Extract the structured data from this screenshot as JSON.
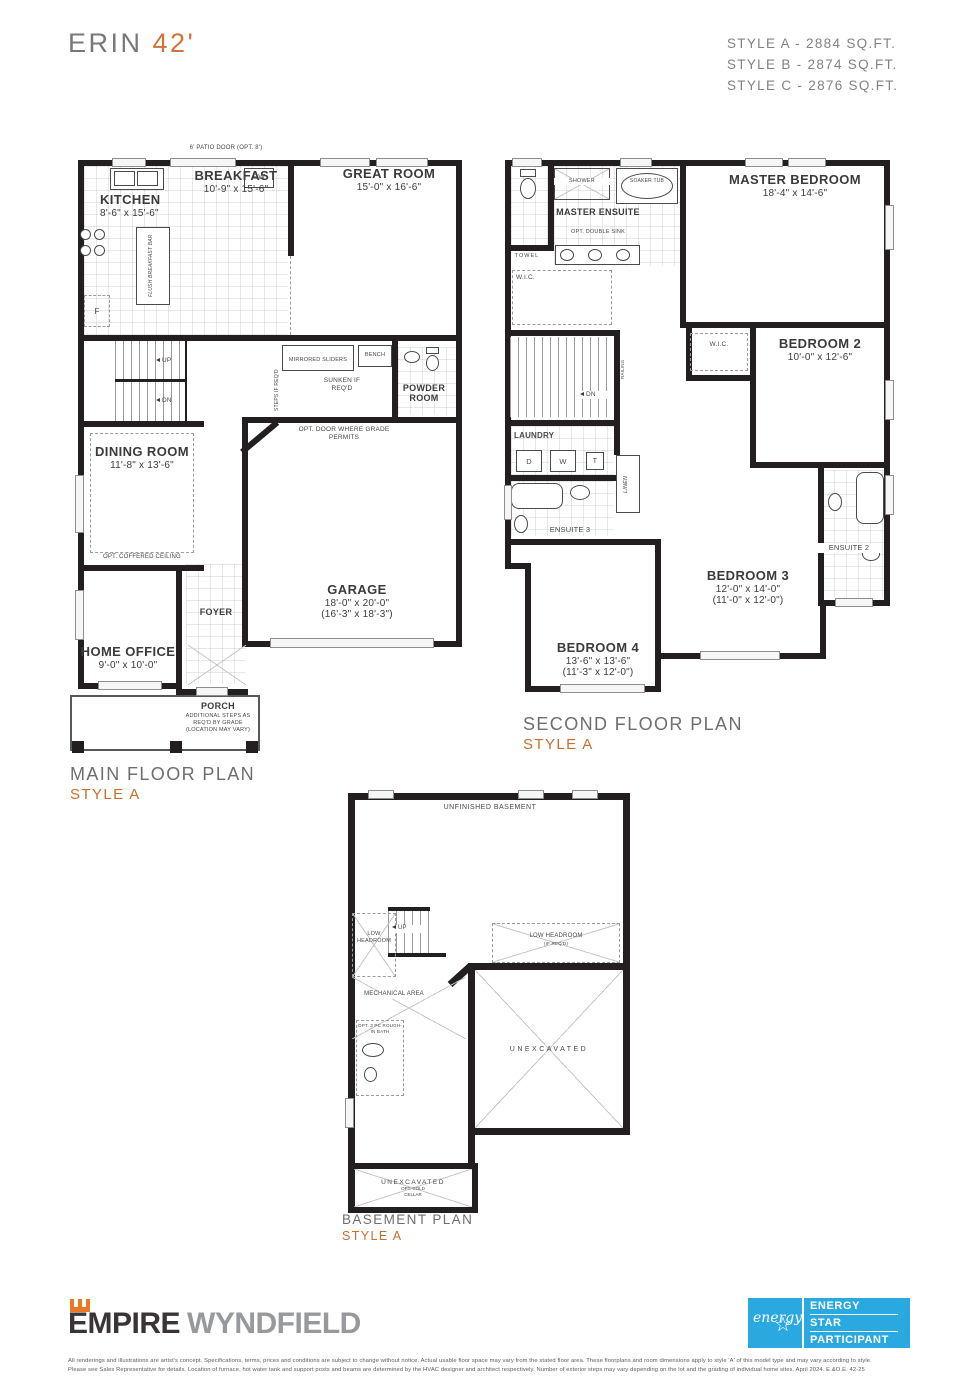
{
  "colors": {
    "accent": "#C76F2E",
    "wall": "#231F20",
    "energy_blue": "#2AA9E0",
    "title_gray": "#6D6E71"
  },
  "header": {
    "title_name": "ERIN",
    "title_size": "42'",
    "style_a": "STYLE A - 2884 SQ.FT.",
    "style_b": "STYLE B - 2874 SQ.FT.",
    "style_c": "STYLE C - 2876 SQ.FT."
  },
  "main": {
    "plan_label": "MAIN FLOOR PLAN",
    "style": "STYLE A",
    "patio_door": "6' PATIO DOOR (OPT. 8')",
    "kitchen_name": "KITCHEN",
    "kitchen_dims": "8'-6\" x 15'-6\"",
    "breakfast_name": "BREAKFAST",
    "breakfast_dims": "10'-9\" x 15'-6\"",
    "great_room_name": "GREAT ROOM",
    "great_room_dims": "15'-0\" x 16'-6\"",
    "dining_name": "DINING ROOM",
    "dining_dims": "11'-8\" x 13'-6\"",
    "dining_note": "OPT. COFFERED CEILING",
    "garage_name": "GARAGE",
    "garage_dims": "18'-0\" x 20'-0\"",
    "garage_dims2": "(16'-3\" x 18'-3\")",
    "home_office_name": "HOME OFFICE",
    "home_office_dims": "9'-0\" x 10'-0\"",
    "foyer_label": "FOYER",
    "porch_label": "PORCH",
    "porch_note": "ADDITIONAL STEPS AS REQ'D BY GRADE (LOCATION MAY VARY)",
    "powder_label": "POWDER ROOM",
    "dw_label": "DW",
    "fridge_label": "F",
    "island_label": "FLUSH BREAKFAST BAR",
    "sliders_label": "MIRRORED SLIDERS",
    "bench_label": "BENCH",
    "sunken_note": "SUNKEN IF REQ'D",
    "steps_note": "STEPS IF REQ'D",
    "opt_door_note": "OPT. DOOR WHERE GRADE PERMITS",
    "up_label": "UP",
    "dn_label": "DN"
  },
  "second": {
    "plan_label": "SECOND FLOOR PLAN",
    "style": "STYLE A",
    "master_name": "MASTER BEDROOM",
    "master_dims": "18'-4\" x 14'-6\"",
    "ensuite_label": "MASTER ENSUITE",
    "ensuite_note": "OPT. DOUBLE SINK",
    "shower_label": "SHOWER",
    "soaker_label": "SOAKER TUB",
    "towel_label": "TOWEL",
    "wic_label": "W.I.C.",
    "wic2_label": "W.I.C.",
    "bed2_name": "BEDROOM 2",
    "bed2_dims": "10'-0\" x 12'-6\"",
    "bed3_name": "BEDROOM 3",
    "bed3_dims": "12'-0\" x 14'-0\"",
    "bed3_dims2": "(11'-0\" x 12'-0\")",
    "bed4_name": "BEDROOM 4",
    "bed4_dims": "13'-6\" x 13'-6\"",
    "bed4_dims2": "(11'-3\" x 12'-0\")",
    "laundry_label": "LAUNDRY",
    "d_label": "D",
    "w_label": "W",
    "t_label": "T",
    "linen_label": "LINEN",
    "ensuite3_label": "ENSUITE 3",
    "ensuite2_label": "ENSUITE 2",
    "railing_label": "RAILING",
    "dn_label": "DN"
  },
  "basement": {
    "plan_label": "BASEMENT PLAN",
    "style": "STYLE A",
    "unfinished_label": "UNFINISHED BASEMENT",
    "low_headroom_label": "LOW HEADROOM",
    "low_headroom_right": "LOW HEADROOM",
    "low_headroom_note": "(IF REQ'D)",
    "mechanical_label": "MECHANICAL AREA",
    "opt_bath_label": "OPT. 3 PC ROUGH-IN BATH",
    "unexcavated_label": "UNEXCAVATED",
    "unexcavated_bottom": "UNEXCAVATED",
    "cold_cellar_note": "OPT. COLD CELLAR",
    "up_label": "UP"
  },
  "footer": {
    "brand1": "EMPIRE",
    "brand2": "WYNDFIELD",
    "energy_script": "energy",
    "energy1": "ENERGY",
    "energy2": "STAR",
    "energy3": "PARTICIPANT",
    "legal1": "All renderings and illustrations are artist's concept. Specifications, terms, prices and conditions are subject to change without notice. Actual usable floor space may vary from the stated floor area. These floorplans and room dimensions apply to style 'A' of this model type and may vary according to style.",
    "legal2": "Please see Sales Representative for details. Location of furnace, hot water tank and support posts and beams are determined by the HVAC designer and architect respectively. Number of exterior steps may vary depending on the lot and the grading of individual home sites. April 2024. E.&O.E. 42-25"
  }
}
